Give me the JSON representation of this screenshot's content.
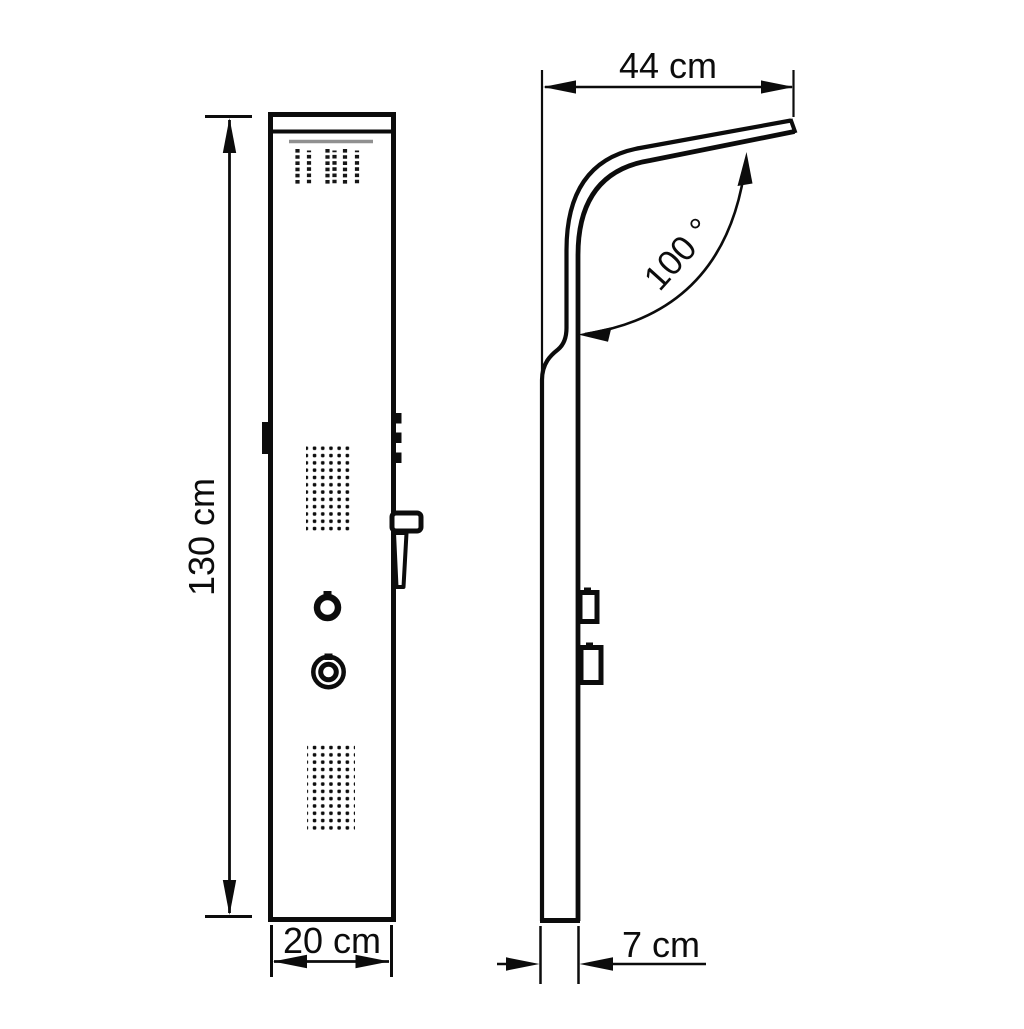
{
  "drawing": {
    "title": "Shower panel dimensional line drawing, front view and side view",
    "colors": {
      "line": "#0c0c0c",
      "gray_detail": "#909090",
      "background": "#ffffff"
    },
    "dimensions": {
      "height_label": "130 cm",
      "width_label": "20 cm",
      "depth_label": "7 cm",
      "reach_label": "44 cm",
      "angle_label": "100 °"
    }
  }
}
